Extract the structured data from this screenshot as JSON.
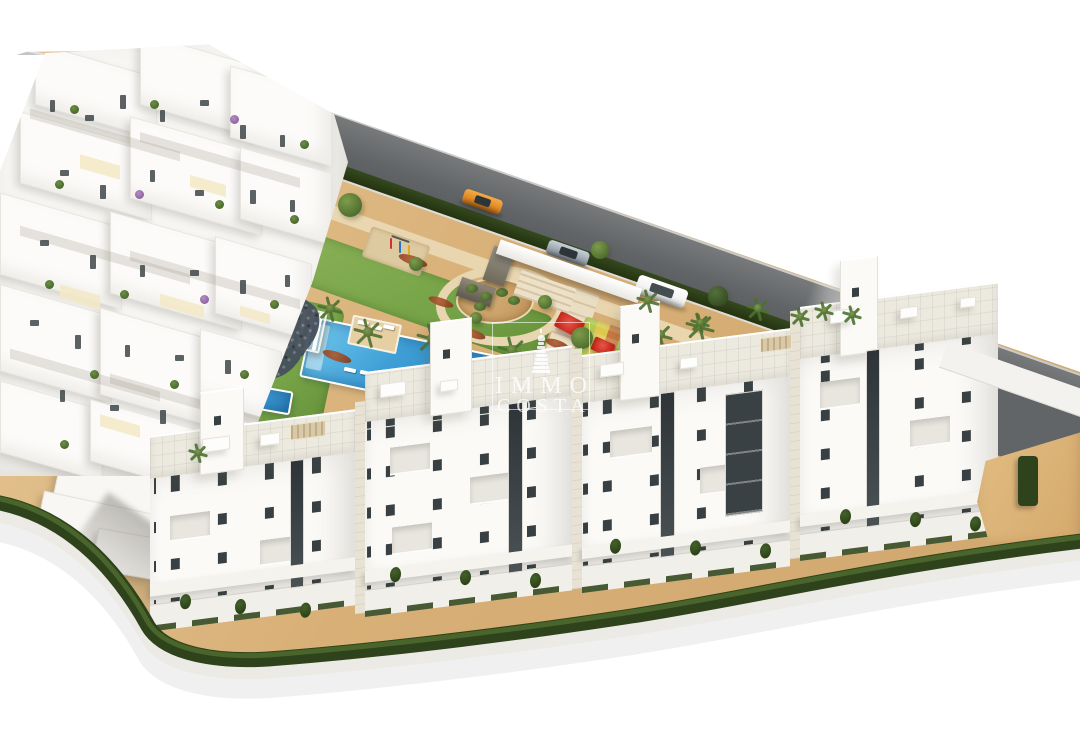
{
  "watermark": {
    "brand_top": "IMMO",
    "brand_bottom": "COSTA",
    "icon": "lighthouse"
  },
  "scene": {
    "subject": "aerial 3d architectural rendering of a white residential apartment complex",
    "features": "communal pool, lawns, playground with red shade sails, landscaped terraces, perimeter road with cars, corner plot fading to white background"
  },
  "colors": {
    "background": "#ffffff",
    "road": "#626567",
    "roadside_hedge": "#35491f",
    "boundary_hedge": "#2e431c",
    "lawn": "#76a347",
    "sand_path": "#d8b077",
    "courtyard_sand": "#d5a96c",
    "pool_water": "#3f9fd6",
    "building_white": "#fbfaf7",
    "building_shadow": "#d9d7d2",
    "terrace_tile": "#ece9df",
    "window_dark": "#384043",
    "hillside_green": "#97a048",
    "playground_red": "#c3251a",
    "car_orange": "#e08a28",
    "car_silver": "#9aa4ad",
    "car_white": "#f2f3f2",
    "watermark_white": "#ffffff"
  }
}
